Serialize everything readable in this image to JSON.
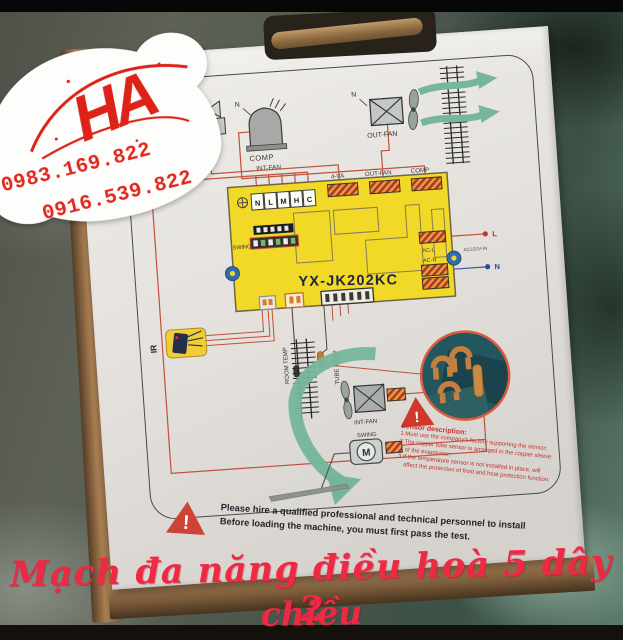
{
  "overlay": {
    "logo": "HA",
    "phone1": "0983.169.822",
    "phone2": "0916.539.822",
    "caption_line1": "Mạch đa năng điều hoà 5 dây 2",
    "caption_line2": "chiều"
  },
  "diagram": {
    "model": "YX-JK202KC",
    "terminals": [
      "N",
      "L",
      "M",
      "H",
      "C"
    ],
    "labels": {
      "valve": "4-VA",
      "n_valve": "N",
      "tilde": "~",
      "comp": "COMP",
      "n_comp": "N",
      "out_fan": "OUT-FAN",
      "n_outfan": "N",
      "int_fan_top": "INT-FAN",
      "conn_4va": "4-VA",
      "conn_outfan": "OUT-FAN",
      "conn_comp": "COMP",
      "swing_conn": "SWING",
      "ac_l": "AC-L",
      "ac_n": "AC-N",
      "ac_in": "AC220V-IN",
      "live": "L",
      "neutral": "N",
      "ir": "IR",
      "room_temp": "ROOM TEMP",
      "tube_temp": "TUBE TEMP",
      "int_fan_bottom": "INT-FAN",
      "swing_motor": "SWING",
      "motor_m": "M",
      "exclaim": "!"
    },
    "sensor_note": {
      "title": "Sensor description:",
      "line1": "1.Must use the company's factory supporting the sensor;",
      "line2": "2.The copper tube sensor is arranged in the copper sleeve",
      "line3": "of the evaporator;",
      "line4": "3.If the temperature sensor is not installed in place, will",
      "line5": "affect the protection of frost and heat protection function."
    },
    "install_note": {
      "line1": "Please hire a qualified professional and technical personnel to install",
      "line2": "Before loading the machine, you must first pass the test."
    }
  },
  "colors": {
    "board_yellow": "#f2d827",
    "wire_red": "#c0503a",
    "wire_blue": "#3a569e",
    "arrow_teal": "#74b59c",
    "accent_red": "#d0382b",
    "caption_pink": "#ee2944"
  }
}
